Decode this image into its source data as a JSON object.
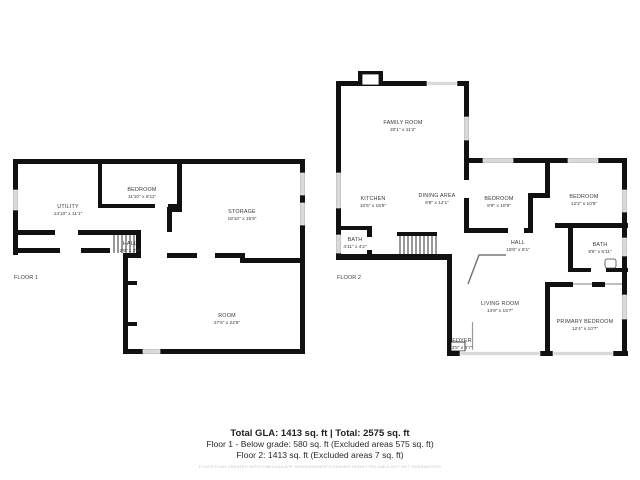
{
  "floor1": {
    "label": "FLOOR 1",
    "rooms": [
      {
        "name": "UTILITY",
        "dims": "14'10\" x 11'1\""
      },
      {
        "name": "BEDROOM",
        "dims": "11'10\" x 8'11\""
      },
      {
        "name": "STORAGE",
        "dims": "18'10\" x 15'9\""
      },
      {
        "name": "HALL",
        "dims": "2'8\" x 3'4\""
      },
      {
        "name": "ROOM",
        "dims": "27'6\" x 22'6\""
      }
    ]
  },
  "floor2": {
    "label": "FLOOR 2",
    "rooms": [
      {
        "name": "FAMILY ROOM",
        "dims": "20'1\" x 11'2\""
      },
      {
        "name": "KITCHEN",
        "dims": "10'5\" x 15'5\""
      },
      {
        "name": "DINING AREA",
        "dims": "9'8\" x 12'1\""
      },
      {
        "name": "BEDROOM",
        "dims": "9'9\" x 10'9\""
      },
      {
        "name": "BEDROOM",
        "dims": "12'2\" x 10'9\""
      },
      {
        "name": "BATH",
        "dims": "4'11\" x 4'2\""
      },
      {
        "name": "HALL",
        "dims": "18'6\" x 8'1\""
      },
      {
        "name": "BATH",
        "dims": "8'6\" x 6'11\""
      },
      {
        "name": "LIVING ROOM",
        "dims": "14'9\" x 15'7\""
      },
      {
        "name": "PRIMARY BEDROOM",
        "dims": "12'4\" x 10'7\""
      },
      {
        "name": "FOYER",
        "dims": "3'5\" x 4'7\""
      }
    ]
  },
  "summary": {
    "total_line": "Total GLA: 1413 sq. ft | Total: 2575 sq. ft",
    "floor1_line": "Floor 1 - Below grade: 580 sq. ft (Excluded areas 575 sq. ft)",
    "floor2_line": "Floor 2: 1413 sq. ft (Excluded areas 7 sq. ft)",
    "disclaimer": "FLOOR PLAN CREATED WITH CUBICASA APP. MEASUREMENTS DEEMED HIGHLY RELIABLE BUT NOT GUARANTEED"
  },
  "colors": {
    "wall": "#111111",
    "window": "#d9d9d9",
    "stair_line": "#333333",
    "railing": "#777777",
    "label_text": "#3a3a3a",
    "disclaimer_text": "#c6c6c6"
  }
}
